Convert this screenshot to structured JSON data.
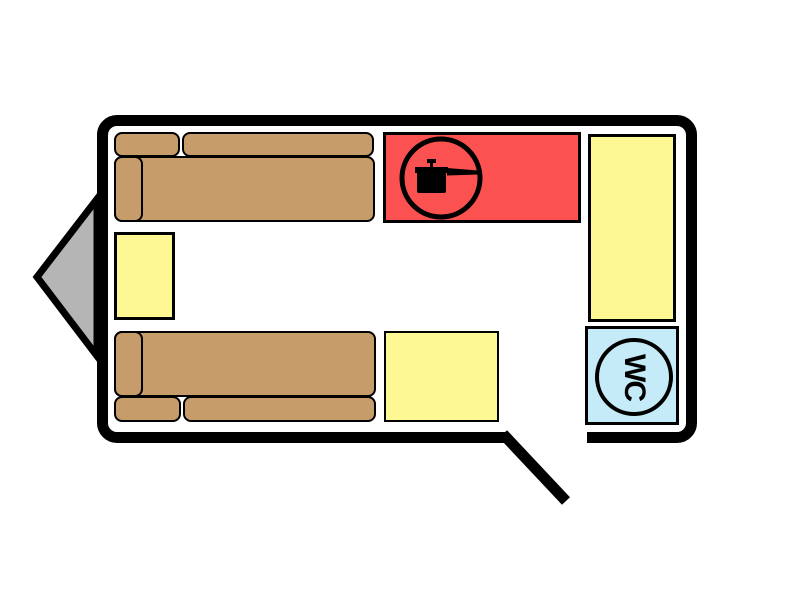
{
  "floorplan": {
    "name": "caravan-floor-plan",
    "wc_label": "WC",
    "colors": {
      "wall": "#000000",
      "background": "#ffffff",
      "hitch_gray": "#b5b5b5",
      "sofa_brown": "#c79c6b",
      "furniture_yellow": "#fdf894",
      "kitchen_red": "#fb5251",
      "toilet_blue": "#c5eaf8"
    },
    "icons": {
      "kitchen": "cooking-pot-icon",
      "toilet": "wc-roundel-icon",
      "hitch": "hitch-triangle"
    },
    "areas": [
      {
        "name": "front-sofa",
        "kind": "sofa"
      },
      {
        "name": "side-table",
        "kind": "table"
      },
      {
        "name": "rear-sofa",
        "kind": "sofa"
      },
      {
        "name": "kitchen-unit",
        "kind": "kitchen"
      },
      {
        "name": "entry-step",
        "kind": "cabinet"
      },
      {
        "name": "wardrobe",
        "kind": "cabinet"
      },
      {
        "name": "toilet-room",
        "kind": "wc"
      },
      {
        "name": "entry-door",
        "kind": "door"
      },
      {
        "name": "hitch",
        "kind": "drawbar"
      }
    ]
  }
}
